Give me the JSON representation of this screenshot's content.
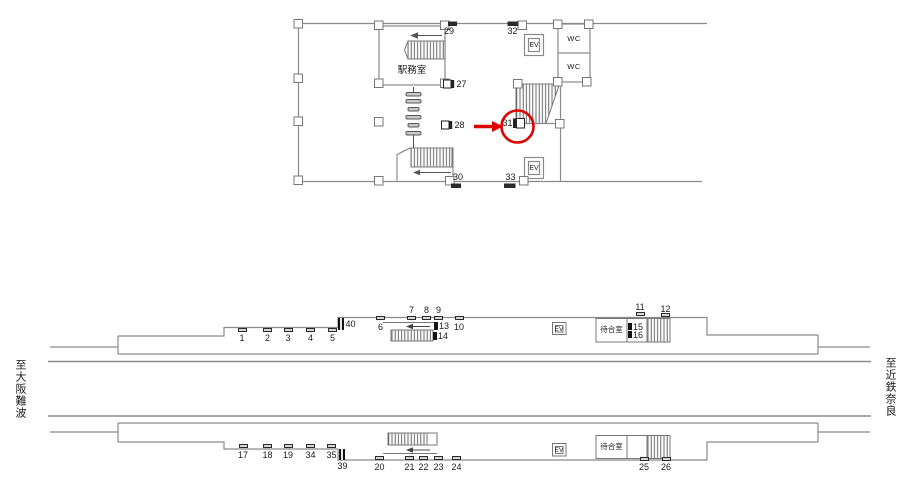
{
  "diagram_type": "station-ad-location-map",
  "colors": {
    "line": "#8a8a8a",
    "structure": "#777777",
    "dark": "#222222",
    "text": "#1a1a1a",
    "highlight_red": "#e00000"
  },
  "directions": {
    "left": "至大阪難波",
    "right": "至近鉄奈良"
  },
  "concourse": {
    "office_label": "駅務室",
    "wc_labels": [
      "WC",
      "WC"
    ],
    "ev_labels": [
      "EV",
      "EV"
    ],
    "highlight": {
      "type": "circle-arrow",
      "color": "#e00000",
      "target": "31"
    },
    "markers": [
      {
        "label": "29",
        "anchor": "c",
        "x": 449,
        "y": 27
      },
      {
        "label": "32",
        "anchor": "c",
        "x": 512.5,
        "y": 27
      },
      {
        "label": "27",
        "anchor": "l",
        "x": 456.5,
        "y": 79.5
      },
      {
        "label": "28",
        "anchor": "l",
        "x": 454.5,
        "y": 120.5
      },
      {
        "label": "31",
        "anchor": "r",
        "x": 512.5,
        "y": 118.5
      },
      {
        "label": "30",
        "anchor": "c",
        "x": 458,
        "y": 172.5
      },
      {
        "label": "33",
        "anchor": "c",
        "x": 510.5,
        "y": 172.5
      }
    ]
  },
  "platforms": {
    "upper": {
      "waiting_room_label": "待合室",
      "ev_label": "EV",
      "markers": [
        {
          "label": "1",
          "anchor": "c",
          "x": 242,
          "y": 334,
          "tick": {
            "x": 237.5,
            "y": 327.5,
            "w": 9,
            "h": 4,
            "style": "plat"
          }
        },
        {
          "label": "2",
          "anchor": "c",
          "x": 267.5,
          "y": 334,
          "tick": {
            "x": 263,
            "y": 327.5,
            "w": 9,
            "h": 4,
            "style": "plat"
          }
        },
        {
          "label": "3",
          "anchor": "c",
          "x": 288,
          "y": 334,
          "tick": {
            "x": 283.5,
            "y": 327.5,
            "w": 9,
            "h": 4,
            "style": "plat"
          }
        },
        {
          "label": "4",
          "anchor": "c",
          "x": 310.5,
          "y": 334,
          "tick": {
            "x": 306,
            "y": 327.5,
            "w": 9,
            "h": 4,
            "style": "plat"
          }
        },
        {
          "label": "5",
          "anchor": "c",
          "x": 332.5,
          "y": 334,
          "tick": {
            "x": 328,
            "y": 327.5,
            "w": 9,
            "h": 4,
            "style": "plat"
          }
        },
        {
          "label": "40",
          "anchor": "l",
          "x": 345.5,
          "y": 319.5,
          "tick": {
            "x": 338,
            "y": 318,
            "w": 6,
            "h": 11.5,
            "style": "sign"
          }
        },
        {
          "label": "6",
          "anchor": "c",
          "x": 380.5,
          "y": 322.5,
          "tick": {
            "x": 376,
            "y": 315.5,
            "w": 9,
            "h": 4,
            "style": "plat"
          }
        },
        {
          "label": "7",
          "anchor": "c",
          "x": 411.5,
          "y": 305.5,
          "tick": {
            "x": 407,
            "y": 316,
            "w": 9,
            "h": 4,
            "style": "plat"
          }
        },
        {
          "label": "8",
          "anchor": "c",
          "x": 426.5,
          "y": 305.5,
          "tick": {
            "x": 422,
            "y": 316,
            "w": 9,
            "h": 4,
            "style": "plat"
          }
        },
        {
          "label": "9",
          "anchor": "c",
          "x": 438.5,
          "y": 305.5,
          "tick": {
            "x": 434,
            "y": 316,
            "w": 9,
            "h": 4,
            "style": "plat"
          }
        },
        {
          "label": "10",
          "anchor": "c",
          "x": 459,
          "y": 322.5,
          "tick": {
            "x": 454.5,
            "y": 315.5,
            "w": 9,
            "h": 4,
            "style": "plat"
          }
        },
        {
          "label": "13",
          "anchor": "l",
          "x": 439,
          "y": 321.5,
          "tick": {
            "x": 433.5,
            "y": 321.5,
            "w": 4,
            "h": 8,
            "style": "black"
          }
        },
        {
          "label": "14",
          "anchor": "l",
          "x": 438,
          "y": 331.5,
          "tick": {
            "x": 432.5,
            "y": 331.5,
            "w": 4,
            "h": 8,
            "style": "black"
          }
        },
        {
          "label": "11",
          "anchor": "c",
          "x": 640,
          "y": 303,
          "tick": {
            "x": 635.5,
            "y": 311.5,
            "w": 9,
            "h": 4,
            "style": "plat"
          }
        },
        {
          "label": "12",
          "anchor": "c",
          "x": 665.5,
          "y": 304.5,
          "tick": {
            "x": 661,
            "y": 313,
            "w": 9,
            "h": 4,
            "style": "plat"
          }
        },
        {
          "label": "15",
          "anchor": "l",
          "x": 633,
          "y": 322.5,
          "tick": {
            "x": 628,
            "y": 322.5,
            "w": 4,
            "h": 7.5,
            "style": "black"
          }
        },
        {
          "label": "16",
          "anchor": "l",
          "x": 633,
          "y": 330.5,
          "tick": {
            "x": 628,
            "y": 330.5,
            "w": 4,
            "h": 7.5,
            "style": "black"
          }
        }
      ]
    },
    "lower": {
      "waiting_room_label": "待合室",
      "ev_label": "EV",
      "markers": [
        {
          "label": "17",
          "anchor": "c",
          "x": 243,
          "y": 450.5,
          "tick": {
            "x": 238.5,
            "y": 444,
            "w": 9,
            "h": 4,
            "style": "plat"
          }
        },
        {
          "label": "18",
          "anchor": "c",
          "x": 267.5,
          "y": 450.5,
          "tick": {
            "x": 263,
            "y": 444,
            "w": 9,
            "h": 4,
            "style": "plat"
          }
        },
        {
          "label": "19",
          "anchor": "c",
          "x": 288,
          "y": 450.5,
          "tick": {
            "x": 283.5,
            "y": 444,
            "w": 9,
            "h": 4,
            "style": "plat"
          }
        },
        {
          "label": "34",
          "anchor": "c",
          "x": 310.5,
          "y": 450.5,
          "tick": {
            "x": 306,
            "y": 444,
            "w": 9,
            "h": 4,
            "style": "plat"
          }
        },
        {
          "label": "35",
          "anchor": "c",
          "x": 331.5,
          "y": 450.5,
          "tick": {
            "x": 327,
            "y": 444,
            "w": 9,
            "h": 4,
            "style": "plat"
          }
        },
        {
          "label": "39",
          "anchor": "c",
          "x": 342.5,
          "y": 461.5,
          "tick": {
            "x": 339,
            "y": 448.5,
            "w": 6,
            "h": 11,
            "style": "sign"
          }
        },
        {
          "label": "20",
          "anchor": "c",
          "x": 379.5,
          "y": 462.5,
          "tick": {
            "x": 375,
            "y": 456,
            "w": 9,
            "h": 4,
            "style": "plat"
          }
        },
        {
          "label": "21",
          "anchor": "c",
          "x": 409.5,
          "y": 462.5,
          "tick": {
            "x": 405,
            "y": 456,
            "w": 9,
            "h": 4,
            "style": "plat"
          }
        },
        {
          "label": "22",
          "anchor": "c",
          "x": 423.5,
          "y": 462.5,
          "tick": {
            "x": 419,
            "y": 456,
            "w": 9,
            "h": 4,
            "style": "plat"
          }
        },
        {
          "label": "23",
          "anchor": "c",
          "x": 438.5,
          "y": 462.5,
          "tick": {
            "x": 434,
            "y": 456,
            "w": 9,
            "h": 4,
            "style": "plat"
          }
        },
        {
          "label": "24",
          "anchor": "c",
          "x": 456.5,
          "y": 462.5,
          "tick": {
            "x": 452,
            "y": 456,
            "w": 9,
            "h": 4,
            "style": "plat"
          }
        },
        {
          "label": "25",
          "anchor": "c",
          "x": 644,
          "y": 462.5,
          "tick": {
            "x": 639.5,
            "y": 456.5,
            "w": 9,
            "h": 4,
            "style": "plat"
          }
        },
        {
          "label": "26",
          "anchor": "c",
          "x": 666,
          "y": 462.5,
          "tick": {
            "x": 661.5,
            "y": 456.5,
            "w": 9,
            "h": 4,
            "style": "plat"
          }
        }
      ]
    }
  }
}
